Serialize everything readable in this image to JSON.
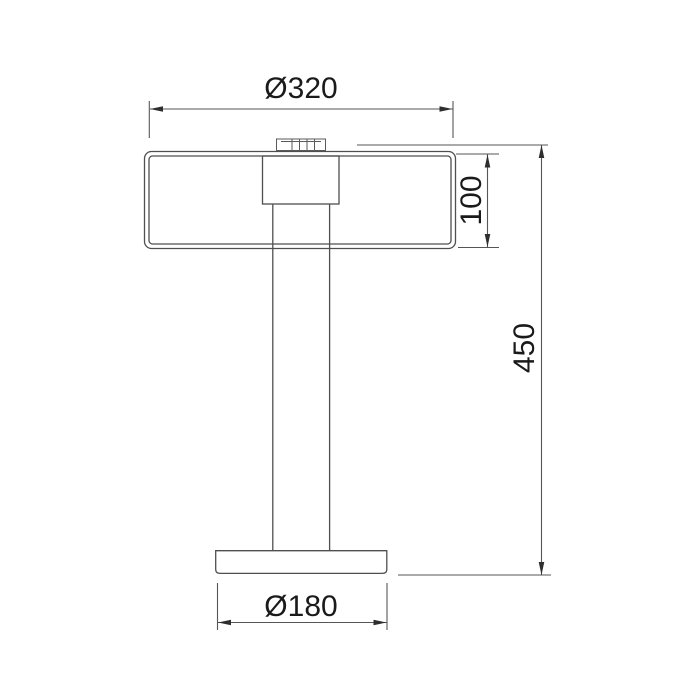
{
  "drawing": {
    "type": "technical-dimension-drawing",
    "subject": "table lamp elevation",
    "background_color": "#ffffff",
    "line_color": "#4f4f4f",
    "text_color": "#1a1a1a",
    "parts": [
      "shade",
      "finial",
      "socket-housing",
      "column",
      "base"
    ],
    "dimensions": {
      "shade_diameter": {
        "label": "Ø320",
        "value": 320,
        "orientation": "horizontal",
        "position": "top"
      },
      "shade_height": {
        "label": "100",
        "value": 100,
        "orientation": "vertical",
        "position": "right-of-shade"
      },
      "total_height": {
        "label": "450",
        "value": 450,
        "orientation": "vertical",
        "position": "far-right"
      },
      "base_diameter": {
        "label": "Ø180",
        "value": 180,
        "orientation": "horizontal",
        "position": "bottom"
      }
    }
  }
}
